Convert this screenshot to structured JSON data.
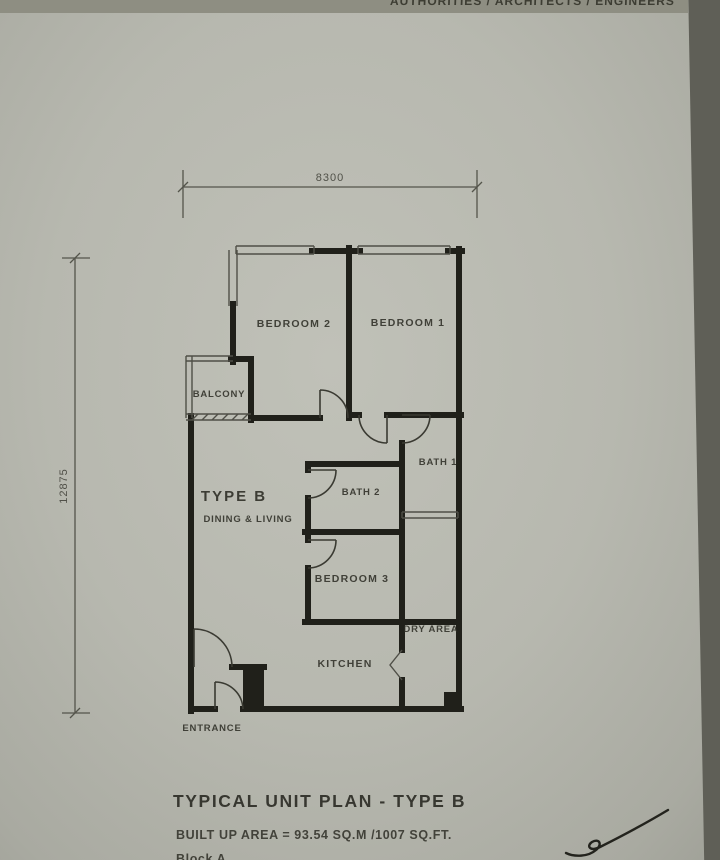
{
  "header": {
    "clipped_text": "AUTHORITIES / ARCHITECTS / ENGINEERS"
  },
  "plan": {
    "dimensions": {
      "width": "8300",
      "height": "12875"
    },
    "rooms": {
      "bedroom_2": "BEDROOM 2",
      "bedroom_1": "BEDROOM 1",
      "balcony": "BALCONY",
      "type_b": "TYPE B",
      "dining_living": "DINING & LIVING",
      "bath_1": "BATH 1",
      "bath_2": "BATH 2",
      "bedroom_3": "BEDROOM 3",
      "dry_area": "DRY AREA",
      "kitchen": "KITCHEN",
      "entrance": "ENTRANCE"
    }
  },
  "footer": {
    "title": "TYPICAL UNIT PLAN - TYPE B",
    "area_line": "BUILT UP AREA = 93.54 SQ.M /1007 SQ.FT.",
    "block_line": "Block A"
  },
  "colors": {
    "paper": "#b7b8af",
    "ink": "#20201a",
    "background": "#5f5f57"
  }
}
